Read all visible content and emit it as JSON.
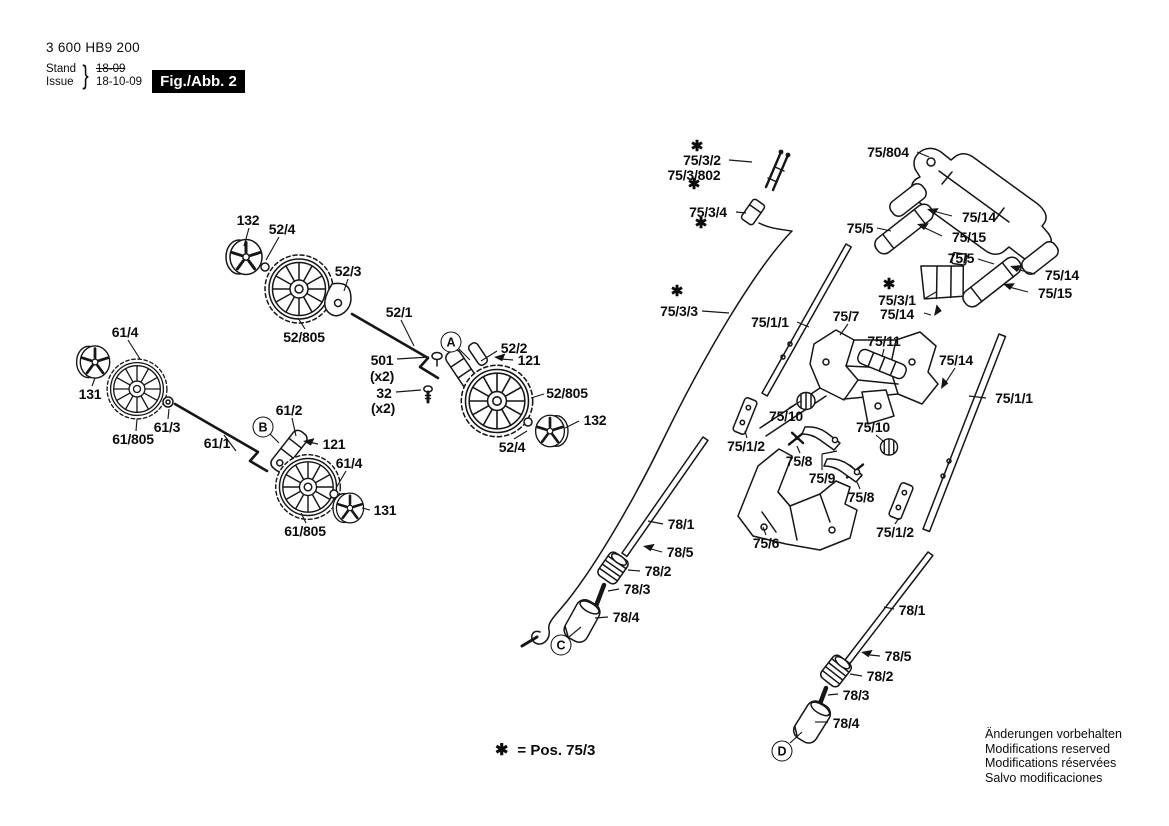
{
  "header": {
    "part_number": "3 600 HB9 200",
    "revision": {
      "stand_label": "Stand",
      "issue_label": "Issue",
      "brace": "}",
      "old_date": "18-09",
      "new_date": "18-10-09"
    },
    "figure_label": "Fig./Abb. 2"
  },
  "footnote": {
    "star": "✱",
    "text": "= Pos. 75/3"
  },
  "legal_lines": [
    "Änderungen vorbehalten",
    "Modifications reserved",
    "Modifications réservées",
    "Salvo modificaciones"
  ],
  "star_glyph": "✱",
  "stars": [
    {
      "x": 697,
      "y": 146
    },
    {
      "x": 694,
      "y": 184
    },
    {
      "x": 701,
      "y": 223
    },
    {
      "x": 677,
      "y": 291
    },
    {
      "x": 889,
      "y": 284
    }
  ],
  "view_markers": [
    {
      "label": "A",
      "x": 451,
      "y": 342,
      "line": [
        459,
        349,
        470,
        360
      ]
    },
    {
      "label": "B",
      "x": 263,
      "y": 427,
      "line": [
        270,
        434,
        279,
        443
      ]
    },
    {
      "label": "C",
      "x": 561,
      "y": 645,
      "line": [
        569,
        637,
        581,
        627
      ]
    },
    {
      "label": "D",
      "x": 782,
      "y": 751,
      "line": [
        790,
        743,
        802,
        732
      ]
    }
  ],
  "callouts": [
    {
      "text": "132",
      "x": 248,
      "y": 220,
      "line": [
        249,
        228,
        244,
        246
      ]
    },
    {
      "text": "52/4",
      "x": 282,
      "y": 229,
      "line": [
        279,
        237,
        266,
        260
      ]
    },
    {
      "text": "52/3",
      "x": 348,
      "y": 271,
      "line": [
        348,
        279,
        344,
        291
      ]
    },
    {
      "text": "52/805",
      "x": 304,
      "y": 337,
      "line": [
        305,
        329,
        298,
        318
      ]
    },
    {
      "text": "61/4",
      "x": 125,
      "y": 332,
      "line": [
        128,
        340,
        140,
        359
      ]
    },
    {
      "text": "131",
      "x": 90,
      "y": 394,
      "line": [
        92,
        386,
        95,
        378
      ]
    },
    {
      "text": "61/3",
      "x": 167,
      "y": 427,
      "line": [
        168,
        419,
        169,
        409
      ]
    },
    {
      "text": "61/805",
      "x": 133,
      "y": 439,
      "line": [
        136,
        431,
        137,
        419
      ]
    },
    {
      "text": "61/1",
      "x": 217,
      "y": 443,
      "line": [
        224,
        435,
        236,
        451
      ]
    },
    {
      "text": "61/2",
      "x": 289,
      "y": 410,
      "line": [
        292,
        418,
        296,
        436
      ]
    },
    {
      "text": "121",
      "x": 334,
      "y": 444,
      "line": [
        318,
        444,
        308,
        442
      ]
    },
    {
      "text": "61/4",
      "x": 349,
      "y": 463,
      "line": [
        346,
        471,
        336,
        488
      ]
    },
    {
      "text": "131",
      "x": 385,
      "y": 510,
      "line": [
        370,
        510,
        362,
        508
      ]
    },
    {
      "text": "61/805",
      "x": 305,
      "y": 531,
      "line": [
        306,
        523,
        301,
        513
      ]
    },
    {
      "text": "52/1",
      "x": 399,
      "y": 312,
      "line": [
        401,
        320,
        414,
        346
      ]
    },
    {
      "text": "52/2",
      "x": 514,
      "y": 348,
      "line": [
        497,
        351,
        481,
        361
      ]
    },
    {
      "text": "121",
      "x": 529,
      "y": 360,
      "line": [
        513,
        360,
        501,
        359
      ]
    },
    {
      "text": "501",
      "x": 382,
      "y": 360,
      "line": [
        397,
        359,
        429,
        357
      ]
    },
    {
      "text": "(x2)",
      "x": 382,
      "y": 376
    },
    {
      "text": "32",
      "x": 384,
      "y": 393,
      "line": [
        396,
        392,
        421,
        390
      ]
    },
    {
      "text": "(x2)",
      "x": 383,
      "y": 408
    },
    {
      "text": "52/805",
      "x": 567,
      "y": 393,
      "line": [
        544,
        394,
        531,
        398
      ]
    },
    {
      "text": "132",
      "x": 595,
      "y": 420,
      "line": [
        579,
        421,
        565,
        428
      ]
    },
    {
      "text": "52/4",
      "x": 512,
      "y": 447,
      "line": [
        514,
        439,
        527,
        431
      ]
    },
    {
      "text": "75/3/2",
      "x": 702,
      "y": 160,
      "line": [
        729,
        160,
        752,
        162
      ]
    },
    {
      "text": "75/3/802",
      "x": 694,
      "y": 175
    },
    {
      "text": "75/3/4",
      "x": 708,
      "y": 212,
      "line": [
        736,
        212,
        746,
        213
      ]
    },
    {
      "text": "75/3/3",
      "x": 679,
      "y": 311,
      "line": [
        702,
        311,
        729,
        313
      ]
    },
    {
      "text": "75/804",
      "x": 888,
      "y": 152,
      "line": [
        917,
        152,
        929,
        157
      ]
    },
    {
      "text": "75/5",
      "x": 860,
      "y": 228,
      "line": [
        877,
        228,
        891,
        231
      ]
    },
    {
      "text": "75/14",
      "x": 979,
      "y": 217,
      "line": [
        952,
        216,
        933,
        211
      ]
    },
    {
      "text": "75/15",
      "x": 969,
      "y": 237,
      "line": [
        942,
        236,
        923,
        227
      ]
    },
    {
      "text": "75/5",
      "x": 961,
      "y": 258,
      "line": [
        978,
        259,
        994,
        264
      ]
    },
    {
      "text": "75/14",
      "x": 1062,
      "y": 275,
      "line": [
        1035,
        274,
        1016,
        269
      ]
    },
    {
      "text": "75/15",
      "x": 1055,
      "y": 293,
      "line": [
        1028,
        292,
        1009,
        287
      ]
    },
    {
      "text": "75/3/1",
      "x": 897,
      "y": 300,
      "line": [
        924,
        299,
        936,
        292
      ]
    },
    {
      "text": "75/14",
      "x": 897,
      "y": 314,
      "line": [
        924,
        313,
        931,
        315
      ]
    },
    {
      "text": "75/7",
      "x": 846,
      "y": 316,
      "line": [
        848,
        324,
        840,
        335
      ]
    },
    {
      "text": "75/1/1",
      "x": 770,
      "y": 322,
      "line": [
        797,
        322,
        809,
        327
      ]
    },
    {
      "text": "75/11",
      "x": 884,
      "y": 341,
      "line": [
        884,
        349,
        882,
        357
      ]
    },
    {
      "text": "75/14",
      "x": 956,
      "y": 360,
      "line": [
        955,
        368,
        944,
        385
      ]
    },
    {
      "text": "75/1/1",
      "x": 1014,
      "y": 398,
      "line": [
        986,
        398,
        969,
        396
      ]
    },
    {
      "text": "75/10",
      "x": 786,
      "y": 416,
      "line": [
        789,
        408,
        801,
        401
      ]
    },
    {
      "text": "75/10",
      "x": 873,
      "y": 427,
      "line": [
        876,
        435,
        884,
        442
      ]
    },
    {
      "text": "75/1/2",
      "x": 746,
      "y": 446,
      "line": [
        747,
        438,
        745,
        431
      ]
    },
    {
      "text": "75/8",
      "x": 799,
      "y": 461,
      "line": [
        800,
        453,
        797,
        446
      ]
    },
    {
      "text": "75/9",
      "x": 822,
      "y": 478,
      "line": [
        822,
        470,
        822,
        454
      ],
      "line2": [
        822,
        454,
        837,
        451
      ]
    },
    {
      "text": "75/8",
      "x": 861,
      "y": 497,
      "line": [
        860,
        489,
        857,
        482
      ]
    },
    {
      "text": "75/1/2",
      "x": 895,
      "y": 532,
      "line": [
        895,
        524,
        899,
        518
      ]
    },
    {
      "text": "75/6",
      "x": 766,
      "y": 543,
      "line": [
        766,
        535,
        763,
        527
      ]
    },
    {
      "text": "78/1",
      "x": 681,
      "y": 524,
      "line": [
        663,
        524,
        648,
        521
      ]
    },
    {
      "text": "78/5",
      "x": 680,
      "y": 552,
      "line": [
        662,
        552,
        651,
        549
      ]
    },
    {
      "text": "78/2",
      "x": 658,
      "y": 571,
      "line": [
        640,
        571,
        628,
        570
      ]
    },
    {
      "text": "78/3",
      "x": 637,
      "y": 589,
      "line": [
        619,
        589,
        608,
        591
      ]
    },
    {
      "text": "78/4",
      "x": 626,
      "y": 617,
      "line": [
        608,
        617,
        595,
        618
      ]
    },
    {
      "text": "78/1",
      "x": 912,
      "y": 610,
      "line": [
        894,
        609,
        884,
        607
      ]
    },
    {
      "text": "78/5",
      "x": 898,
      "y": 656,
      "line": [
        880,
        656,
        870,
        655
      ]
    },
    {
      "text": "78/2",
      "x": 880,
      "y": 676,
      "line": [
        862,
        676,
        850,
        674
      ]
    },
    {
      "text": "78/3",
      "x": 856,
      "y": 695,
      "line": [
        838,
        694,
        828,
        695
      ]
    },
    {
      "text": "78/4",
      "x": 846,
      "y": 723,
      "line": [
        828,
        722,
        815,
        722
      ]
    }
  ]
}
